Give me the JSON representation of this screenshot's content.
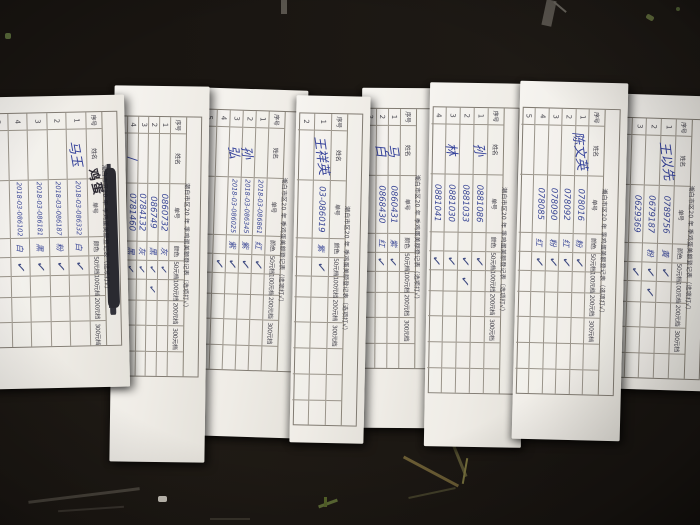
{
  "scene": {
    "description": "photo of eight overlapping paper registration slips on a dark table",
    "colors": {
      "background": "#191511",
      "paper": "#f2efe9",
      "ink_blue": "#3a4796",
      "printed_text": "#42414a",
      "grid_line": "#9a948a"
    }
  },
  "check_glyph": "✓",
  "form_title": "潮白市区20 年 季鸡蛋美额登记表（选项打√）",
  "form_labels": {
    "index": "序号",
    "name": "姓名",
    "serial": "单号",
    "color": "颜色",
    "tiers": [
      "50元档",
      "100元档",
      "200元档",
      "300元档"
    ]
  },
  "forms": [
    {
      "id": "a",
      "slots": 5,
      "scribbled_title": true,
      "note": "鸡蛋",
      "names": [
        "马玉",
        "",
        "",
        "",
        ""
      ],
      "serials": [
        "2018-03-086332",
        "2018-03-086187",
        "2018-03-086181",
        "2018-03-086102",
        ""
      ],
      "colors": [
        "白",
        "粉",
        "黑",
        "白",
        ""
      ],
      "checks50": [
        1,
        1,
        1,
        1,
        0
      ],
      "checks100": [
        0,
        0,
        0,
        0,
        0
      ]
    },
    {
      "id": "b",
      "slots": 5,
      "names": [
        "",
        "",
        "",
        "∕",
        ""
      ],
      "serials": [
        "0860732",
        "086749",
        "0784132",
        "0781460",
        ""
      ],
      "colors": [
        "灰",
        "黑",
        "灰",
        "黑",
        ""
      ],
      "checks50": [
        1,
        1,
        1,
        1,
        0
      ],
      "checks100": [
        0,
        1,
        0,
        0,
        0
      ]
    },
    {
      "id": "c",
      "slots": 5,
      "names": [
        "",
        "孙",
        "弘",
        "",
        ""
      ],
      "serials": [
        "2018-03-086861",
        "2018-03-086345",
        "2018-03-086025",
        "",
        ""
      ],
      "colors": [
        "红",
        "紫",
        "紫",
        "",
        ""
      ],
      "checks50": [
        1,
        1,
        1,
        1,
        0
      ],
      "checks100": [
        0,
        0,
        0,
        0,
        0
      ]
    },
    {
      "id": "d",
      "slots": 2,
      "names": [
        "王祥英",
        ""
      ],
      "serials": [
        "03-086019",
        ""
      ],
      "colors": [
        "紫",
        ""
      ],
      "checks50": [
        1,
        0
      ],
      "checks100": [
        0,
        0
      ]
    },
    {
      "id": "e",
      "slots": 3,
      "names": [
        "马",
        "白",
        ""
      ],
      "serials": [
        "0860431",
        "0868430",
        ""
      ],
      "colors": [
        "紫",
        "红",
        ""
      ],
      "checks50": [
        1,
        1,
        0
      ],
      "checks100": [
        0,
        0,
        0
      ]
    },
    {
      "id": "f",
      "slots": 4,
      "names": [
        "孙",
        "",
        "林",
        ""
      ],
      "serials": [
        "0881086",
        "0881033",
        "0881030",
        "0881041"
      ],
      "colors": [
        "",
        "",
        "",
        ""
      ],
      "checks50": [
        1,
        1,
        1,
        1
      ],
      "checks100": [
        0,
        1,
        0,
        0
      ]
    },
    {
      "id": "g",
      "slots": 5,
      "names": [
        "陈文英",
        "",
        "",
        "",
        ""
      ],
      "serials": [
        "078016",
        "078092",
        "078090",
        "078085",
        ""
      ],
      "colors": [
        "粉",
        "红",
        "粉",
        "红",
        ""
      ],
      "checks50": [
        1,
        1,
        1,
        1,
        0
      ],
      "checks100": [
        0,
        0,
        0,
        0,
        0
      ]
    },
    {
      "id": "h",
      "slots": 4,
      "names": [
        "王以先",
        "",
        "",
        ""
      ],
      "serials": [
        "0789756",
        "0679187",
        "0629369",
        ""
      ],
      "colors": [
        "黄",
        "粉",
        "",
        ""
      ],
      "checks50": [
        1,
        1,
        1,
        0
      ],
      "checks100": [
        0,
        1,
        0,
        0
      ]
    }
  ]
}
